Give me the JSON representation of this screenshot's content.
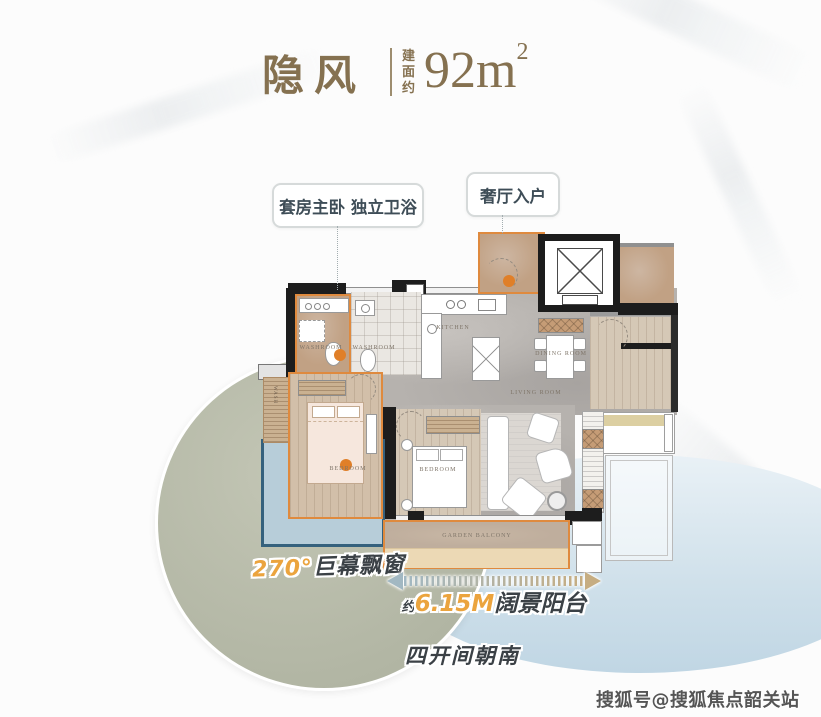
{
  "header": {
    "title": "隐风",
    "area_label": "建面约",
    "area_value": "92m",
    "area_exp": "2"
  },
  "callouts": {
    "suite": "套房主卧 独立卫浴",
    "entry": "奢厅入户"
  },
  "plan": {
    "labels": {
      "washroom_suite": "WASHROOM",
      "washroom": "WASHROOM",
      "kitchen": "KITCHEN",
      "dining_room": "DINING ROOM",
      "living_room": "LIVING ROOM",
      "bedroom_master": "BEDROOM",
      "bedroom_second": "BEDROOM",
      "garden_balcony": "GARDEN BALCONY",
      "wardrobe": "WASH"
    }
  },
  "annotations": {
    "bay_window": {
      "value": "270°",
      "label": "巨幕飘窗"
    },
    "balcony": {
      "prefix": "约",
      "value": "6.15M",
      "label": "阔景阳台"
    },
    "orientation": "四开间朝南"
  },
  "watermark": "搜狐号@搜狐焦点韶关站",
  "colors": {
    "title_brown": "#857150",
    "accent_orange": "#DF8A3E",
    "accent_gold": "#EBA43E",
    "bay_blue_border": "#35617D",
    "bay_blue_fill": "#B7CDD9",
    "sage_circle": "#B7BBA9",
    "light_blue_ellipse": "#CFE0EA",
    "dark_text": "#3B4146",
    "callout_text": "#3E4D57"
  }
}
